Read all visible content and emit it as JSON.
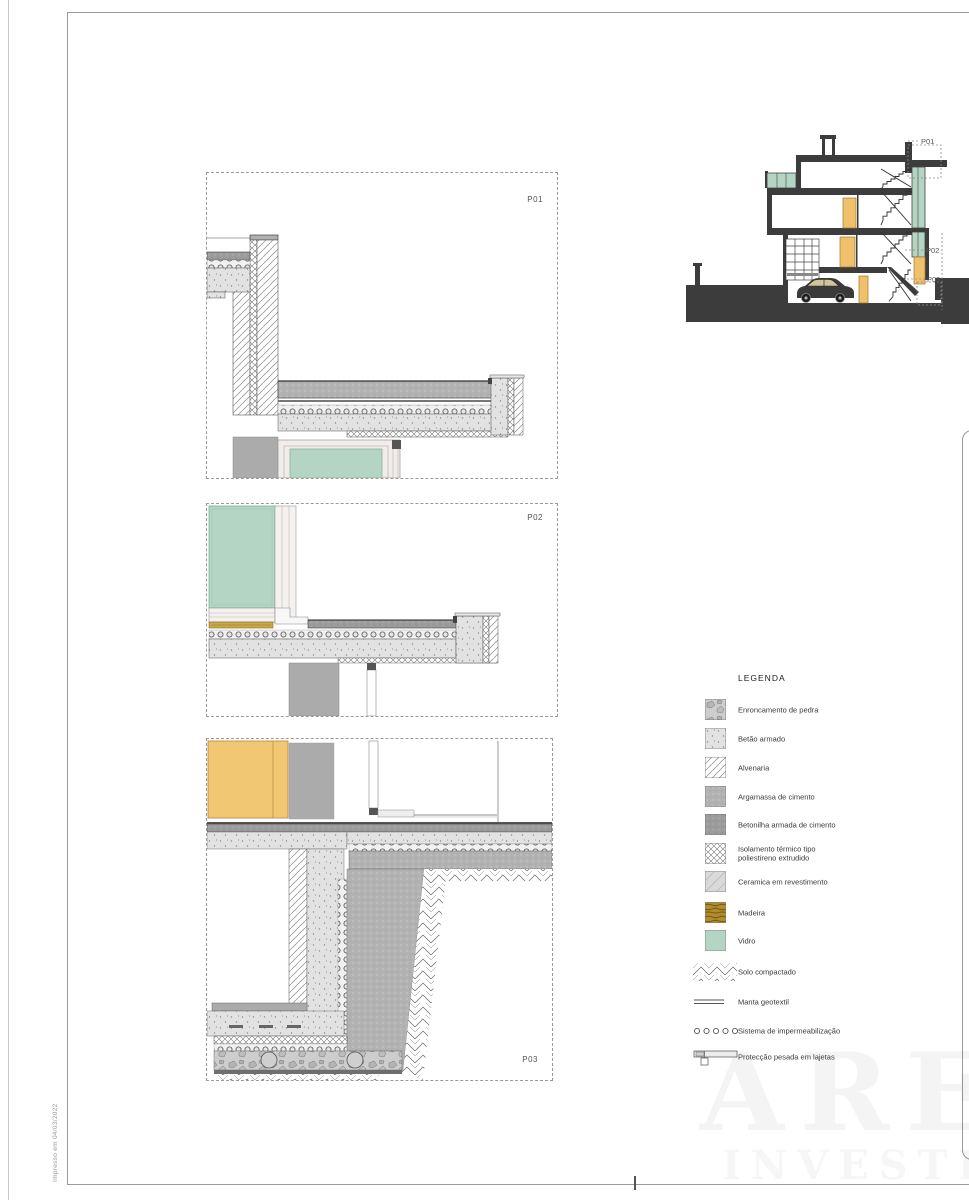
{
  "sheet": {
    "print_note": "Impresso em 04/03/2022",
    "watermark_line1": "ARE",
    "watermark_line2": "INVESTIM"
  },
  "details": {
    "p01": {
      "label": "P01"
    },
    "p02": {
      "label": "P02"
    },
    "p03": {
      "label": "P03"
    }
  },
  "section": {
    "callout_p01": "P01",
    "callout_p02": "P02",
    "callout_p03": "P03"
  },
  "legend": {
    "title": "LEGENDA",
    "items": [
      {
        "label": "Enroncamento de pedra"
      },
      {
        "label": "Betão armado"
      },
      {
        "label": "Alvenaria"
      },
      {
        "label": "Argamassa de cimento"
      },
      {
        "label": "Betonilha armada de cimento"
      },
      {
        "label": "Isolamento térmico tipo",
        "label2": "poliestireno extrudido"
      },
      {
        "label": "Ceramica em revestimento"
      },
      {
        "label": "Madeira"
      },
      {
        "label": "Vidro"
      },
      {
        "label": "Solo compactado"
      },
      {
        "label": "Manta geotextil"
      },
      {
        "label": "Sistema de impermeabilização"
      },
      {
        "label": "Protecção pesada em lajetas"
      }
    ]
  },
  "colors": {
    "glass": "#b4d5c3",
    "door_wood": "#f2c774",
    "legend_wood": "#b08c2e",
    "poche": "#3c3c3c",
    "mortar": "#b0b0b0",
    "screed": "#9c9c9c"
  }
}
